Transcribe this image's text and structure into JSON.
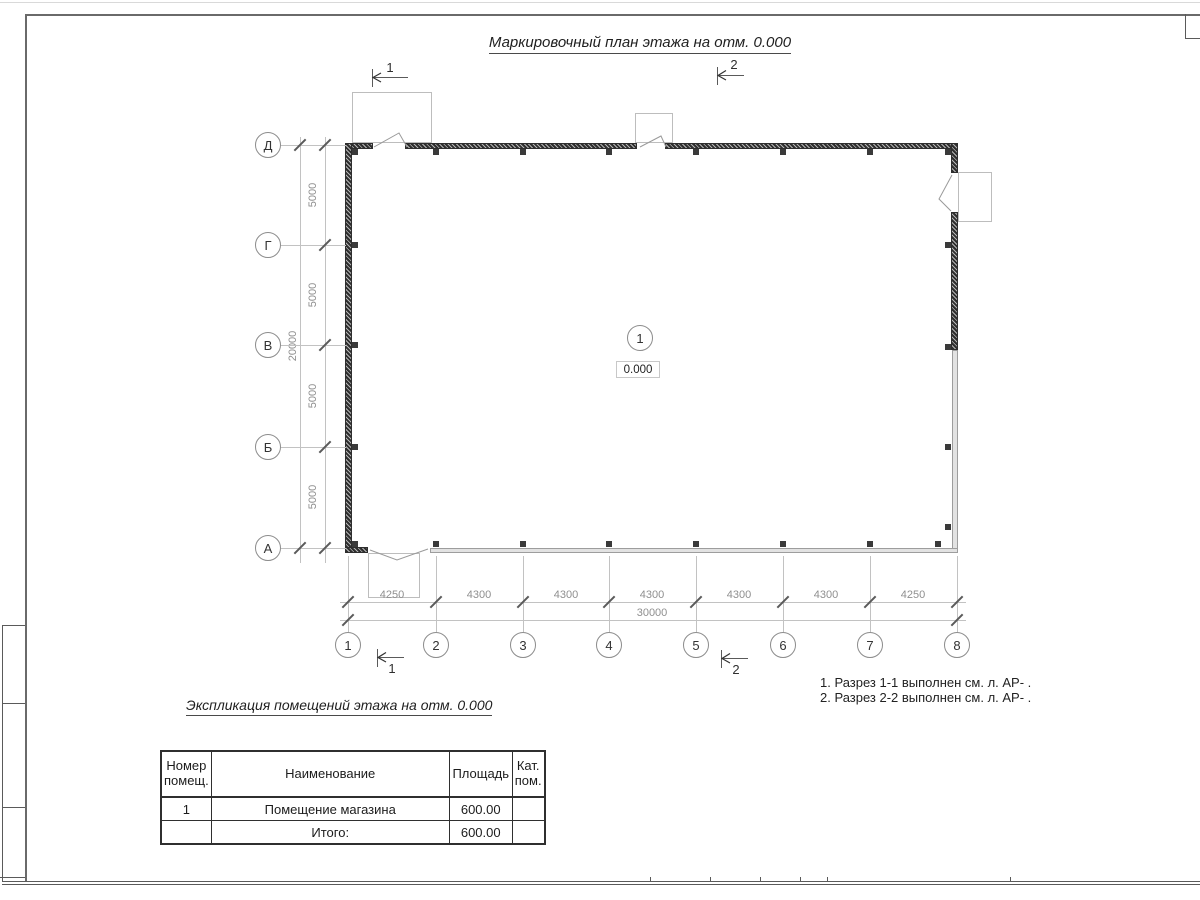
{
  "drawing": {
    "title": "Маркировочный план этажа на отм. 0.000",
    "room_marker": {
      "number": "1",
      "elevation": "0.000"
    },
    "axes": {
      "rows": [
        "Д",
        "Г",
        "В",
        "Б",
        "А"
      ],
      "cols": [
        "1",
        "2",
        "3",
        "4",
        "5",
        "6",
        "7",
        "8"
      ]
    },
    "dimensions": {
      "vertical_segments": [
        "5000",
        "5000",
        "5000",
        "5000"
      ],
      "vertical_total": "20000",
      "horizontal_segments": [
        "4250",
        "4300",
        "4300",
        "4300",
        "4300",
        "4300",
        "4250"
      ],
      "horizontal_total": "30000"
    },
    "section_marks": {
      "top": [
        "1",
        "2"
      ],
      "bottom": [
        "1",
        "2"
      ]
    }
  },
  "notes": {
    "line1": "1. Разрез 1-1 выполнен см. л. АР- .",
    "line2": "2. Разрез 2-2 выполнен см. л. АР- ."
  },
  "schedule": {
    "title": "Экспликация помещений этажа на отм. 0.000",
    "headers": [
      "Номер помещ.",
      "Наименование",
      "Площадь",
      "Кат. пом."
    ],
    "rows": [
      {
        "number": "1",
        "name": "Помещение магазина",
        "area": "600.00",
        "category": ""
      },
      {
        "number": "",
        "name": "Итого:",
        "area": "600.00",
        "category": ""
      }
    ]
  },
  "colors": {
    "ink": "#2f2f2f",
    "dim_text": "#8f8f8f",
    "light_line": "#c2c2c2",
    "wall_dark": "#4a4a4a",
    "wall_light": "#e2e2e2"
  }
}
